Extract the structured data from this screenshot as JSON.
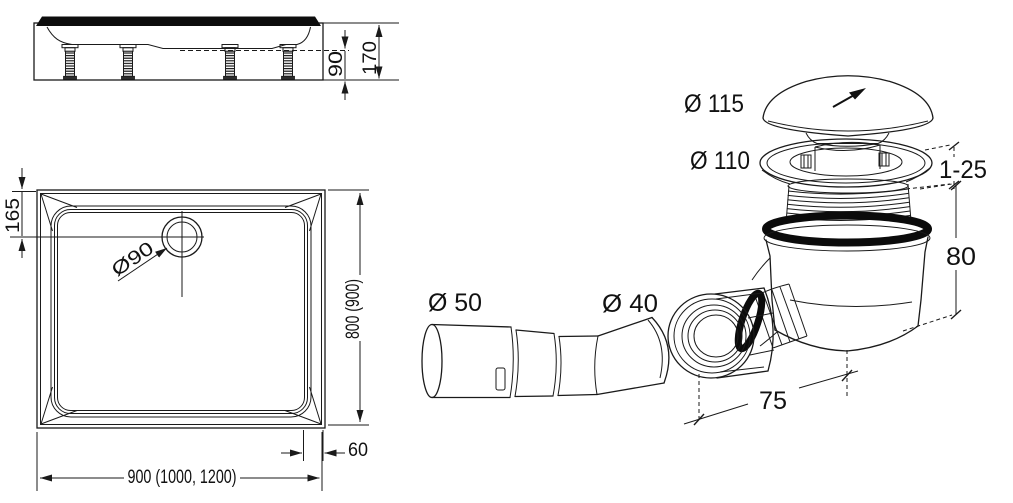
{
  "page": {
    "background": "#ffffff"
  },
  "drawing": {
    "line_color": "#1a1a1a",
    "text_color": "#111111",
    "side_view": {
      "dim_basin_height": "90",
      "dim_total_height": "170"
    },
    "top_view": {
      "dim_drain_center_offset": "165",
      "dim_drain_hole": "Ø90",
      "dim_length": "800 (900)",
      "dim_rim_width": "60",
      "dim_width": "900 (1000, 1200)"
    },
    "drain_assembly": {
      "dim_cap": "Ø 115",
      "dim_flange": "Ø 110",
      "dim_clamp_range": "1-25",
      "dim_body_height": "80",
      "dim_outlet_length": "75",
      "dim_adapter_outer": "Ø 50",
      "dim_adapter_inner": "Ø 40"
    }
  }
}
